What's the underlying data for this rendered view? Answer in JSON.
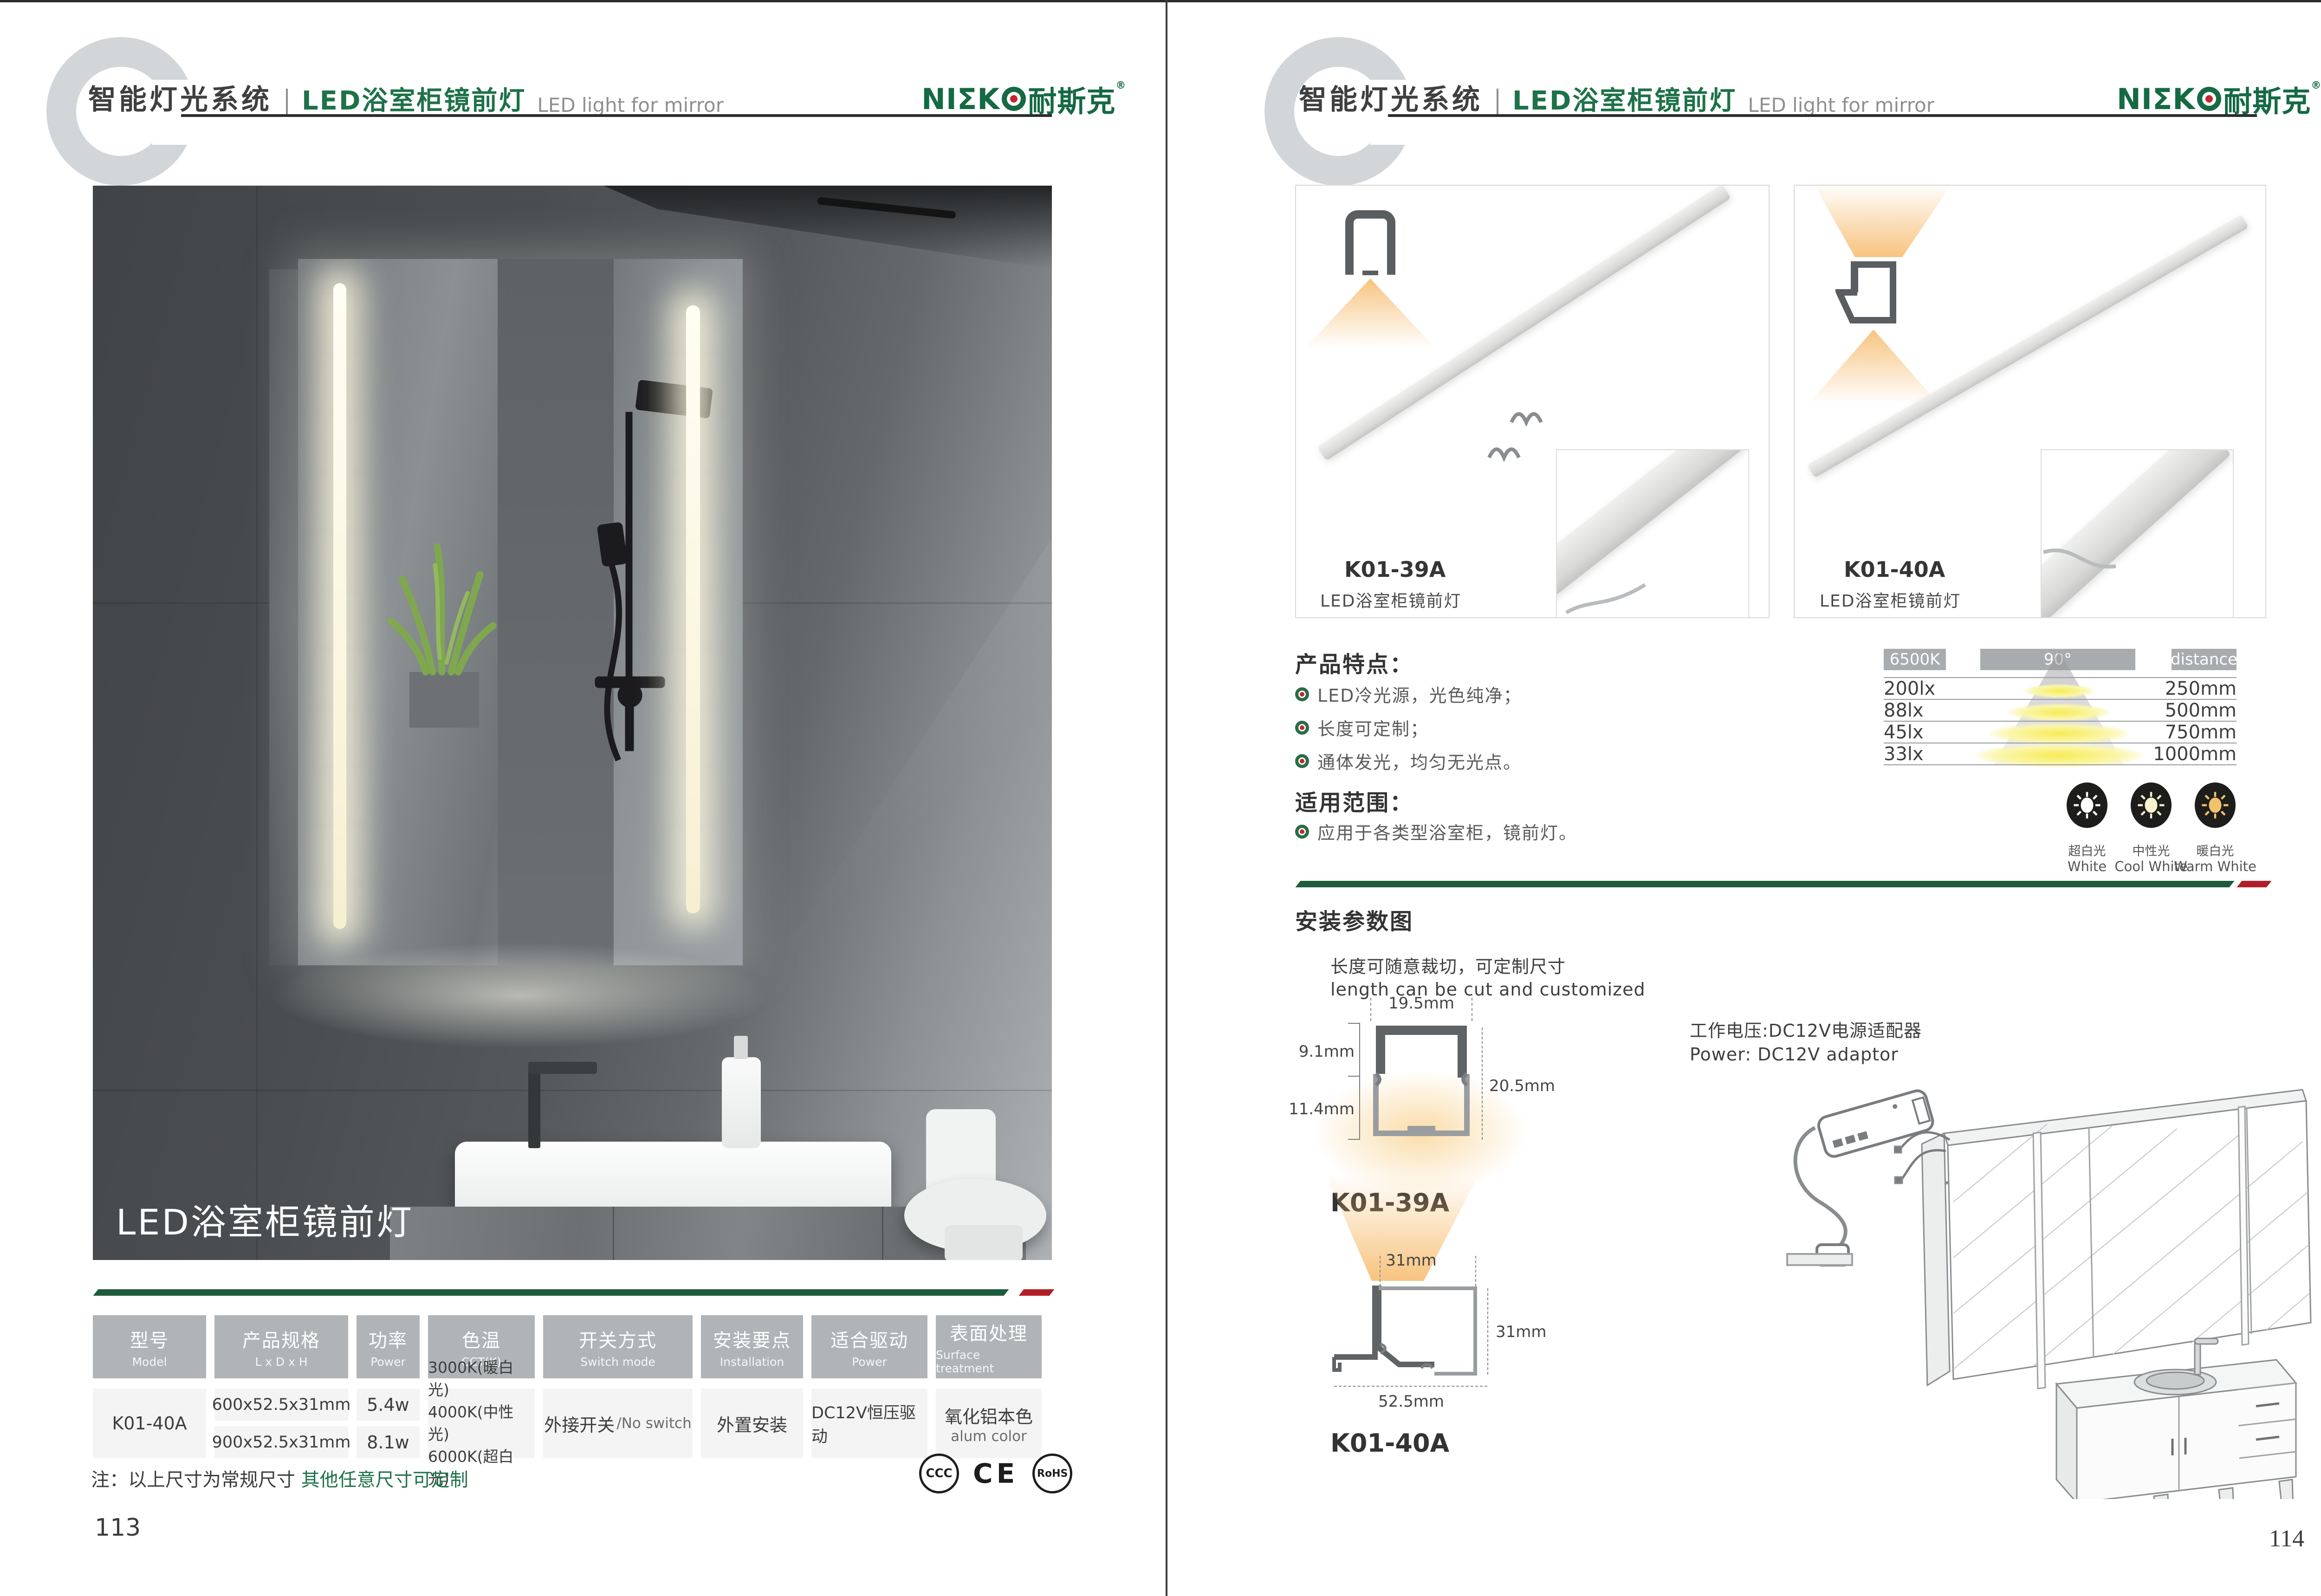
{
  "colors": {
    "brand_green": "#156a43",
    "title_green": "#1e7248",
    "accent_red": "#b01f27",
    "line_green": "#1e5b3c",
    "table_header_gray": "#b0b4b6",
    "glow_orange": "#f6b969",
    "cone_yellow": "#f6ec55"
  },
  "brand": {
    "logo_left": "NIΣK",
    "logo_cn": "耐斯克",
    "reg": "®"
  },
  "header": {
    "system": "智能灯光系统",
    "product_cn": "LED浴室柜镜前灯",
    "product_en": "LED light for mirror"
  },
  "left_page": {
    "photo_caption": "LED浴室柜镜前灯",
    "table": {
      "headers": [
        {
          "main": "型号",
          "sub": "Model"
        },
        {
          "main": "产品规格",
          "sub": "L x D x H"
        },
        {
          "main": "功率",
          "sub": "Power"
        },
        {
          "main": "色温",
          "sub": "CCT(K)"
        },
        {
          "main": "开关方式",
          "sub": "Switch mode"
        },
        {
          "main": "安装要点",
          "sub": "Installation"
        },
        {
          "main": "适合驱动",
          "sub": "Power"
        },
        {
          "main": "表面处理",
          "sub": "Surface treatment"
        }
      ],
      "row": {
        "model": "K01-40A",
        "specs": [
          "600x52.5x31mm",
          "900x52.5x31mm"
        ],
        "power": [
          "5.4w",
          "8.1w"
        ],
        "cct": [
          "3000K(暖白光)",
          "4000K(中性光)",
          "6000K(超白光)"
        ],
        "switch_cn": "外接开关",
        "switch_en": "/No switch",
        "install": "外置安装",
        "driver": "DC12V恒压驱动",
        "surface_cn": "氧化铝本色",
        "surface_en": "alum color"
      }
    },
    "note_prefix": "注：以上尺寸为常规尺寸 ",
    "note_green": "其他任意尺寸可定制",
    "certs": [
      "CCC",
      "CE",
      "RoHS"
    ],
    "page_number": "113"
  },
  "right_page": {
    "products": [
      {
        "model": "K01-39A",
        "name": "LED浴室柜镜前灯"
      },
      {
        "model": "K01-40A",
        "name": "LED浴室柜镜前灯"
      }
    ],
    "features": {
      "title": "产品特点：",
      "items": [
        "LED冷光源，光色纯净；",
        "长度可定制；",
        "通体发光，均匀无光点。"
      ]
    },
    "scope": {
      "title": "适用范围：",
      "items": [
        "应用于各类型浴室柜，镜前灯。"
      ]
    },
    "chart": {
      "type": "table",
      "cct": "6500K",
      "angle": "90°",
      "distance_label": "distance",
      "rows": [
        {
          "lux": "200lx",
          "distance": "250mm"
        },
        {
          "lux": "88lx",
          "distance": "500mm"
        },
        {
          "lux": "45lx",
          "distance": "750mm"
        },
        {
          "lux": "33lx",
          "distance": "1000mm"
        }
      ]
    },
    "cct_options": [
      {
        "cn": "超白光",
        "en": "White"
      },
      {
        "cn": "中性光",
        "en": "Cool White"
      },
      {
        "cn": "暖白光",
        "en": "Warm White"
      }
    ],
    "install": {
      "title": "安装参数图",
      "cut_cn": "长度可随意裁切，可定制尺寸",
      "cut_en": "length can be cut and customized",
      "power_cn": "工作电压:DC12V电源适配器",
      "power_en": "Power: DC12V adaptor",
      "profile1": {
        "model": "K01-39A",
        "dim_top": "19.5mm",
        "dim_left_upper": "9.1mm",
        "dim_left_lower": "11.4mm",
        "dim_right": "20.5mm"
      },
      "profile2": {
        "model": "K01-40A",
        "dim_top": "31mm",
        "dim_right": "31mm",
        "dim_bottom": "52.5mm"
      }
    },
    "page_number": "114"
  }
}
